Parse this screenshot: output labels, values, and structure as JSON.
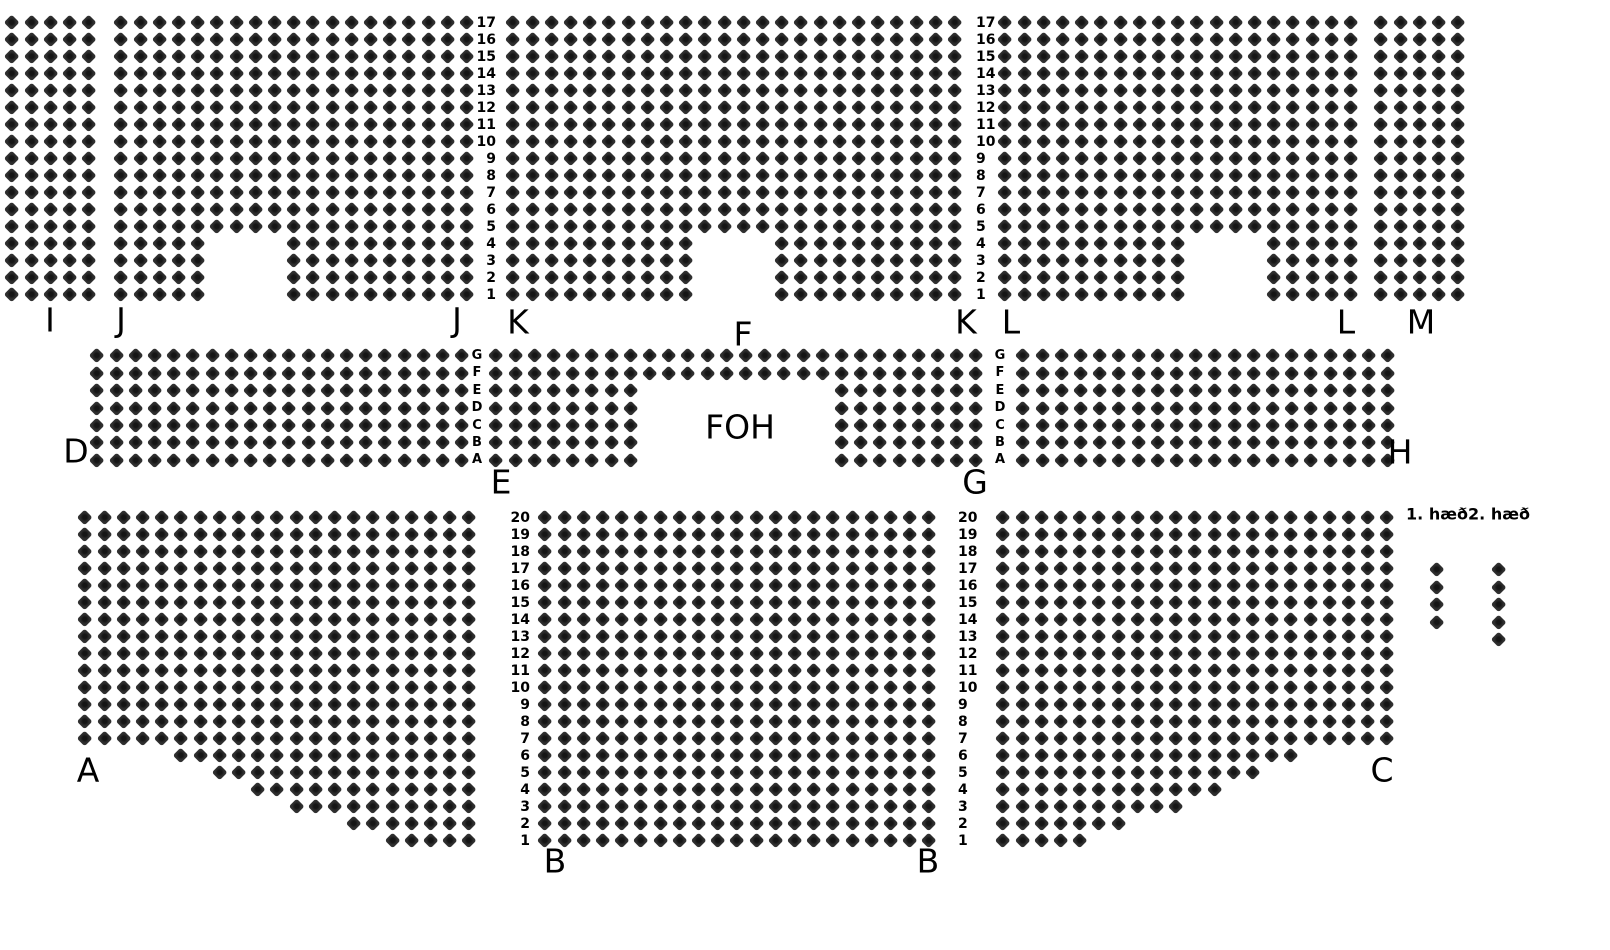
{
  "canvas": {
    "width": 1610,
    "height": 950,
    "background": "#ffffff"
  },
  "seat_style": {
    "diagonal_px": 16,
    "fill": "#2e2e2e",
    "inner": "#151515"
  },
  "sections": [
    {
      "name": "I",
      "x": 12,
      "y": 23,
      "dx": 19.2,
      "dy": 17,
      "rows": [
        {
          "cols": "0-4",
          "repeat": 17
        }
      ]
    },
    {
      "name": "J",
      "x": 121,
      "y": 23,
      "dx": 19.2,
      "dy": 17,
      "rows": [
        {
          "cols": "0-18",
          "repeat": 13
        },
        {
          "cols": "0-4,9-18",
          "repeat": 4
        }
      ]
    },
    {
      "name": "K",
      "x": 513,
      "y": 23,
      "dx": 19.2,
      "dy": 17,
      "rows": [
        {
          "cols": "0-23",
          "repeat": 13
        },
        {
          "cols": "0-9,14-23",
          "repeat": 4
        }
      ]
    },
    {
      "name": "L",
      "x": 1005,
      "y": 23,
      "dx": 19.2,
      "dy": 17,
      "rows": [
        {
          "cols": "0-18",
          "repeat": 13
        },
        {
          "cols": "0-9,14-18",
          "repeat": 4
        }
      ]
    },
    {
      "name": "M",
      "x": 1381,
      "y": 23,
      "dx": 19.2,
      "dy": 17,
      "rows": [
        {
          "cols": "0-4",
          "repeat": 17
        }
      ]
    },
    {
      "name": "D",
      "x": 97,
      "y": 356,
      "dx": 19.2,
      "dy": 17.4,
      "rows": [
        {
          "cols": "0-19",
          "repeat": 7
        }
      ]
    },
    {
      "name": "E-G",
      "x": 496,
      "y": 356,
      "dx": 19.2,
      "dy": 17.4,
      "rows": [
        {
          "cols": "0-25",
          "repeat": 2
        },
        {
          "cols": "0-7,18-25",
          "repeat": 5
        }
      ]
    },
    {
      "name": "H",
      "x": 1023,
      "y": 356,
      "dx": 19.2,
      "dy": 17.4,
      "rows": [
        {
          "cols": "0-19",
          "repeat": 7
        }
      ]
    },
    {
      "name": "A",
      "x": 85,
      "y": 518,
      "dx": 19.2,
      "dy": 17,
      "rows": [
        {
          "cols": "0-20",
          "repeat": 14
        },
        {
          "cols": "5-20",
          "repeat": 1
        },
        {
          "cols": "7-20",
          "repeat": 1
        },
        {
          "cols": "9-20",
          "repeat": 1
        },
        {
          "cols": "11-20",
          "repeat": 1
        },
        {
          "cols": "14-20",
          "repeat": 1
        },
        {
          "cols": "16-20",
          "repeat": 1
        }
      ]
    },
    {
      "name": "B",
      "x": 545,
      "y": 518,
      "dx": 19.2,
      "dy": 17,
      "rows": [
        {
          "cols": "0-20",
          "repeat": 20
        }
      ]
    },
    {
      "name": "C",
      "x": 1003,
      "y": 518,
      "dx": 19.2,
      "dy": 17,
      "rows": [
        {
          "cols": "0-20",
          "repeat": 14
        },
        {
          "cols": "0-15",
          "repeat": 1
        },
        {
          "cols": "0-13",
          "repeat": 1
        },
        {
          "cols": "0-11",
          "repeat": 1
        },
        {
          "cols": "0-9",
          "repeat": 1
        },
        {
          "cols": "0-6",
          "repeat": 1
        },
        {
          "cols": "0-4",
          "repeat": 1
        }
      ]
    }
  ],
  "row_guides": [
    {
      "name": "top-row-numbers-left",
      "x": 496,
      "align": "right",
      "y": 23,
      "dy": 17,
      "style": "num",
      "values": [
        "17",
        "16",
        "15",
        "14",
        "13",
        "12",
        "11",
        "10",
        "9",
        "8",
        "7",
        "6",
        "5",
        "4",
        "3",
        "2",
        "1"
      ]
    },
    {
      "name": "top-row-numbers-right",
      "x": 976,
      "align": "left",
      "y": 23,
      "dy": 17,
      "style": "num",
      "values": [
        "17",
        "16",
        "15",
        "14",
        "13",
        "12",
        "11",
        "10",
        "9",
        "8",
        "7",
        "6",
        "5",
        "4",
        "3",
        "2",
        "1"
      ]
    },
    {
      "name": "mid-row-letters-left",
      "x": 477,
      "align": "center",
      "y": 356,
      "dy": 17.4,
      "style": "letter",
      "values": [
        "G",
        "F",
        "E",
        "D",
        "C",
        "B",
        "A"
      ]
    },
    {
      "name": "mid-row-letters-right",
      "x": 1000,
      "align": "center",
      "y": 356,
      "dy": 17.4,
      "style": "letter",
      "values": [
        "G",
        "F",
        "E",
        "D",
        "C",
        "B",
        "A"
      ]
    },
    {
      "name": "bottom-row-numbers-left",
      "x": 530,
      "align": "right",
      "y": 518,
      "dy": 17,
      "style": "num",
      "values": [
        "20",
        "19",
        "18",
        "17",
        "16",
        "15",
        "14",
        "13",
        "12",
        "11",
        "10",
        "9",
        "8",
        "7",
        "6",
        "5",
        "4",
        "3",
        "2",
        "1"
      ]
    },
    {
      "name": "bottom-row-numbers-right",
      "x": 958,
      "align": "left",
      "y": 518,
      "dy": 17,
      "style": "num",
      "values": [
        "20",
        "19",
        "18",
        "17",
        "16",
        "15",
        "14",
        "13",
        "12",
        "11",
        "10",
        "9",
        "8",
        "7",
        "6",
        "5",
        "4",
        "3",
        "2",
        "1"
      ]
    }
  ],
  "section_labels": [
    {
      "text": "I",
      "x": 50,
      "y": 320
    },
    {
      "text": "J",
      "x": 121,
      "y": 320
    },
    {
      "text": "J",
      "x": 457,
      "y": 320
    },
    {
      "text": "K",
      "x": 518,
      "y": 322
    },
    {
      "text": "F",
      "x": 743,
      "y": 334
    },
    {
      "text": "K",
      "x": 966,
      "y": 322
    },
    {
      "text": "L",
      "x": 1011,
      "y": 322
    },
    {
      "text": "L",
      "x": 1346,
      "y": 322
    },
    {
      "text": "M",
      "x": 1421,
      "y": 322
    },
    {
      "text": "D",
      "x": 76,
      "y": 451
    },
    {
      "text": "E",
      "x": 501,
      "y": 482
    },
    {
      "text": "FOH",
      "x": 740,
      "y": 427
    },
    {
      "text": "G",
      "x": 975,
      "y": 482
    },
    {
      "text": "H",
      "x": 1400,
      "y": 452
    },
    {
      "text": "A",
      "x": 88,
      "y": 770
    },
    {
      "text": "B",
      "x": 555,
      "y": 861
    },
    {
      "text": "B",
      "x": 928,
      "y": 861
    },
    {
      "text": "C",
      "x": 1382,
      "y": 770
    }
  ],
  "legend": {
    "items": [
      {
        "label": "1. hæð",
        "label_x": 1437,
        "label_y": 514,
        "col_x": 1437,
        "col_y": 570,
        "col_dy": 17.4,
        "seat_count": 4
      },
      {
        "label": "2. hæð",
        "label_x": 1499,
        "label_y": 514,
        "col_x": 1499,
        "col_y": 570,
        "col_dy": 17.4,
        "seat_count": 5
      }
    ]
  }
}
